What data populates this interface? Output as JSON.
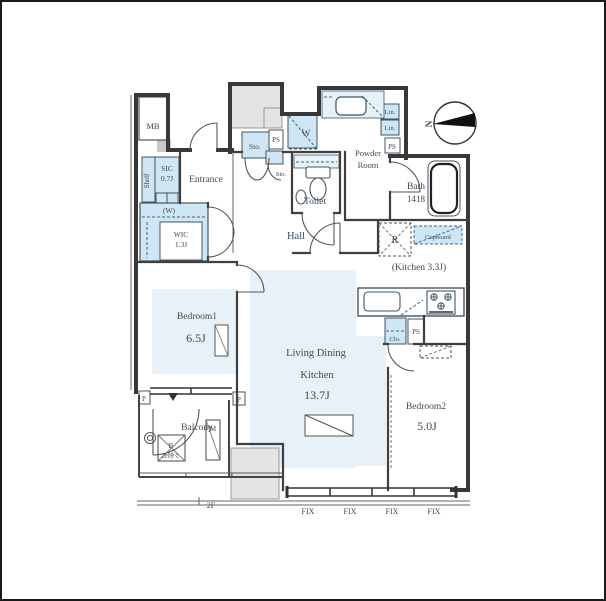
{
  "page": {
    "type": "floor-plan"
  },
  "colors": {
    "floor_tint": "#e7f1f8",
    "fixture_blue": "#cfe6f5",
    "wall": "#383838",
    "gray_area": "#e4e4e4",
    "text": "#3d4a57"
  },
  "rooms": {
    "entrance": {
      "label": "Entrance"
    },
    "sic": {
      "label": "SIC",
      "size": "0.7J",
      "shelf": "Shelf"
    },
    "wic": {
      "label": "WIC",
      "size": "1.3J",
      "hanger": "(W)"
    },
    "bedroom1": {
      "label": "Bedroom1",
      "size": "6.5J"
    },
    "ldk": {
      "label_line1": "Living Dining",
      "label_line2": "Kitchen",
      "size": "13.7J"
    },
    "kitchen": {
      "label": "(Kitchen 3.3J)"
    },
    "bedroom2": {
      "label": "Bedroom2",
      "size": "5.0J"
    },
    "hall": {
      "label": "Hall"
    },
    "toilet": {
      "label": "Toilet"
    },
    "powder_room": {
      "label_line1": "Powder",
      "label_line2": "Room"
    },
    "bath": {
      "label": "Bath",
      "size": "1418"
    },
    "balcony": {
      "label": "Balcony"
    }
  },
  "fixtures": {
    "mb": "MB",
    "storage": "Sto.",
    "storage_small": "Sto.",
    "washer": "W",
    "linen_top": "Lin.",
    "linen_bottom": "Lin.",
    "ps_center": "PS",
    "ps_right": "PS",
    "ps_kitchen": "PS",
    "refrigerator": "R",
    "cupboard": "Cupboard",
    "closet": "Clo.",
    "meter": "M",
    "b_unit": "B",
    "b_note": "2F除く",
    "pillar_left": "P",
    "pillar_right": "P"
  },
  "windows": {
    "fix_labels": [
      "FIX",
      "FIX",
      "FIX",
      "FIX"
    ]
  },
  "annotations": {
    "floor_ref": "2F",
    "north": "N"
  }
}
